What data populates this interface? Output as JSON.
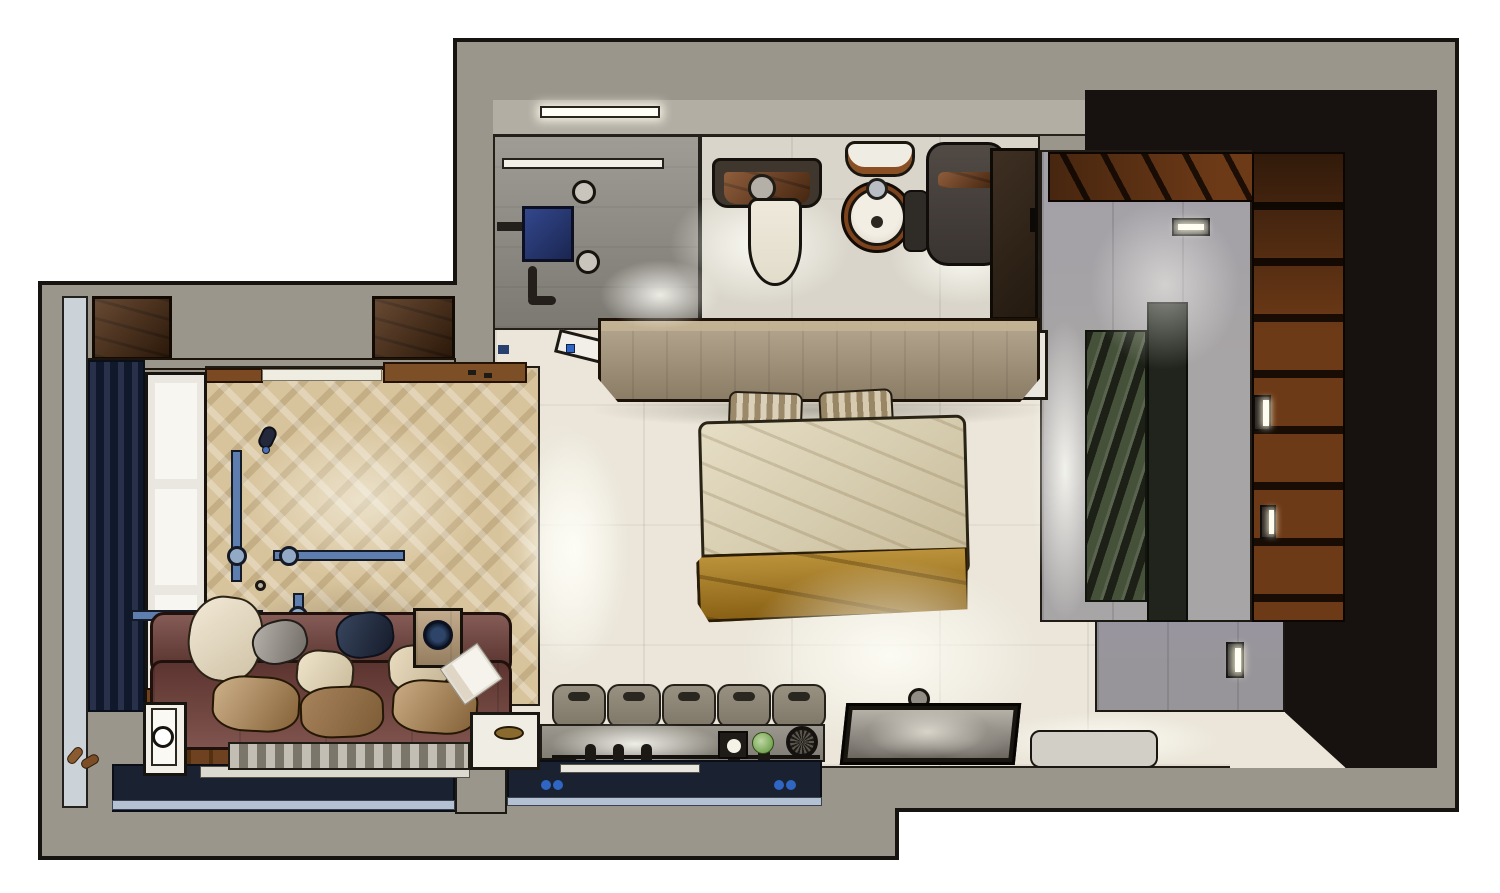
{
  "scene": {
    "description": "3D top-down cutaway render of a studio apartment floor plan with bathroom, sauna, bedroom, lounge and kitchenette",
    "background": "#ffffff"
  },
  "palette": {
    "wall_grey": "#9b968c",
    "outline_dark": "#181410",
    "bath_floor": "#d9d5ca",
    "shower_tile": "#8d8982",
    "wall_face": "#b2aea4",
    "cream_floor": "#ebe6d9",
    "parquet": "#d8c49c",
    "concrete": "#a8a5a6",
    "concrete_wall": "#98959a",
    "sauna_black": "#171210",
    "sauna_wood": "#6d3a17",
    "lounger_green": "#46513a",
    "lounger_frame": "#20241c",
    "desk_wood": "#a8967a",
    "cabinet_wood": "#4f2c11",
    "navy_counter": "#1a2130",
    "navy_curtain": "#16203a",
    "light_strip_blue": "#b3c1d3",
    "steel_blue": "#5d7eae",
    "joint_blue": "#93aac7",
    "sofa_leather": "#71403a",
    "duvet_beige": "#d8cba6",
    "throw_mustard": "#a4761c",
    "pillow_tan": "#a57d4e",
    "chair_grey": "#8d8679",
    "white_fixture": "#f2efe8",
    "sink_wood": "#7c431c",
    "tv_frame": "#18150f",
    "bench_white": "#d2cfc6",
    "accent_blue": "#2f66c4",
    "lettuce_green": "#7fae4a"
  },
  "rooms": [
    {
      "id": "bathroom"
    },
    {
      "id": "walk-in-shower"
    },
    {
      "id": "sauna"
    },
    {
      "id": "bedroom"
    },
    {
      "id": "living-lounge"
    },
    {
      "id": "kitchenette"
    },
    {
      "id": "entry-corridor"
    },
    {
      "id": "tv-area"
    }
  ],
  "furniture": [
    {
      "id": "shower-panel"
    },
    {
      "id": "toilet"
    },
    {
      "id": "round-pedestal-sink"
    },
    {
      "id": "laundry-hamper"
    },
    {
      "id": "bathroom-cabinet"
    },
    {
      "id": "headboard-console-desk"
    },
    {
      "id": "double-bed"
    },
    {
      "id": "sauna-lounger"
    },
    {
      "id": "sauna-plank-bench"
    },
    {
      "id": "sofa"
    },
    {
      "id": "side-table"
    },
    {
      "id": "magazine"
    },
    {
      "id": "woven-bench"
    },
    {
      "id": "floor-platform"
    },
    {
      "id": "bar-chairs"
    },
    {
      "id": "kitchen-counter"
    },
    {
      "id": "wall-tv"
    },
    {
      "id": "white-bench"
    },
    {
      "id": "window"
    },
    {
      "id": "curtain"
    },
    {
      "id": "wardrobe-cabinets"
    },
    {
      "id": "pendant-lights"
    },
    {
      "id": "wall-sconces"
    },
    {
      "id": "entry-door"
    }
  ]
}
